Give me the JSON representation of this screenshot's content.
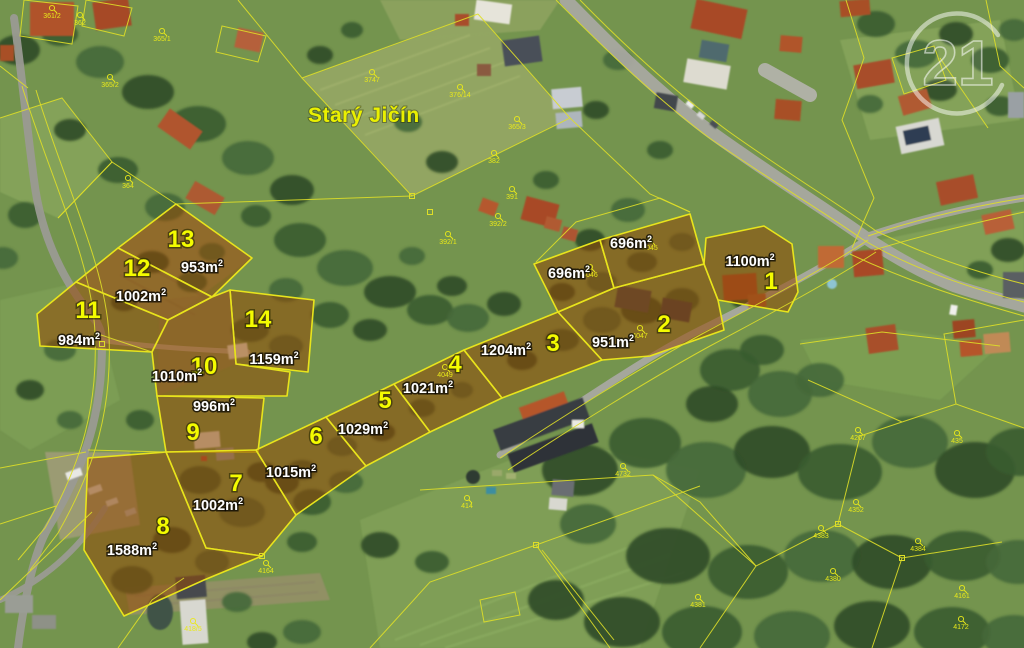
{
  "map": {
    "place_label": "Starý Jičín",
    "watermark_number": "21",
    "accent_colors": {
      "cadastral_line": "#dede28",
      "parcel_highlight": "rgba(148,72,6,0.55)",
      "parcel_number": "#f4fc00",
      "area_label": "#ffffff"
    },
    "area_unit": "m²",
    "parcels": [
      {
        "id": "13",
        "area": "953",
        "num": [
          181,
          247
        ],
        "area_pos": [
          202,
          272
        ],
        "poly": "176,204 252,258 212,297 118,248"
      },
      {
        "id": "12",
        "area": "1002",
        "num": [
          137,
          276
        ],
        "area_pos": [
          141,
          301
        ],
        "poly": "118,248 212,297 168,320 76,282"
      },
      {
        "id": "11",
        "area": "984",
        "num": [
          88,
          318
        ],
        "area_pos": [
          79,
          345
        ],
        "poly": "76,282 168,320 152,352 40,346 37,314"
      },
      {
        "id": "14",
        "area": "1159",
        "num": [
          258,
          327
        ],
        "area_pos": [
          274,
          364
        ],
        "poly": "230,290 314,300 308,372 236,364"
      },
      {
        "id": "10",
        "area": "1010",
        "num": [
          204,
          374
        ],
        "area_pos": [
          177,
          381
        ],
        "poly": "152,352 168,320 212,297 230,290 236,364 290,372 287,396 157,396"
      },
      {
        "id": "9",
        "area": "996",
        "num": [
          193,
          440
        ],
        "area_pos": [
          214,
          411
        ],
        "poly": "157,396 264,398 258,452 166,452"
      },
      {
        "id": "7",
        "area": "1002",
        "num": [
          236,
          491
        ],
        "area_pos": [
          218,
          510
        ],
        "poly": "166,452 256,450 296,515 262,556 206,548"
      },
      {
        "id": "8",
        "area": "1588",
        "num": [
          163,
          534
        ],
        "area_pos": [
          132,
          555
        ],
        "poly": "88,458 166,452 206,548 262,556 204,580 124,616 84,550"
      },
      {
        "id": "6",
        "area": "1015",
        "num": [
          316,
          444
        ],
        "area_pos": [
          291,
          477
        ],
        "poly": "256,450 326,417 366,466 296,515"
      },
      {
        "id": "5",
        "area": "1029",
        "num": [
          385,
          408
        ],
        "area_pos": [
          363,
          434
        ],
        "poly": "326,417 394,384 430,432 366,466"
      },
      {
        "id": "4",
        "area": "1021",
        "num": [
          455,
          372
        ],
        "area_pos": [
          428,
          393
        ],
        "poly": "394,384 464,350 502,398 430,432"
      },
      {
        "id": "3",
        "area": "1204",
        "num": [
          553,
          351
        ],
        "area_pos": [
          506,
          355
        ],
        "poly": "464,350 558,312 602,360 502,398"
      },
      {
        "id": "2",
        "area": "951",
        "num": [
          664,
          332
        ],
        "area_pos": [
          613,
          347
        ],
        "poly": "558,312 614,288 704,264 718,300 724,330 650,356 602,360"
      },
      {
        "id": "1",
        "area": "1100",
        "num": [
          771,
          289
        ],
        "area_pos": [
          750,
          266
        ],
        "poly": "706,238 764,226 792,244 798,292 788,312 718,300 704,264"
      },
      {
        "id": "",
        "area": "696",
        "num": null,
        "area_pos": [
          569,
          278
        ],
        "poly": "534,264 600,240 614,288 558,312"
      },
      {
        "id": "",
        "area": "696",
        "num": null,
        "area_pos": [
          631,
          248
        ],
        "poly": "600,240 690,214 704,264 614,288"
      }
    ],
    "refs": [
      {
        "t": "361/2",
        "x": 52,
        "y": 18
      },
      {
        "t": "362",
        "x": 80,
        "y": 25
      },
      {
        "t": "365/1",
        "x": 162,
        "y": 41
      },
      {
        "t": "365/2",
        "x": 110,
        "y": 87
      },
      {
        "t": "364",
        "x": 128,
        "y": 188
      },
      {
        "t": "3747",
        "x": 372,
        "y": 82
      },
      {
        "t": "376/14",
        "x": 460,
        "y": 97
      },
      {
        "t": "365/3",
        "x": 517,
        "y": 129
      },
      {
        "t": "382",
        "x": 494,
        "y": 163
      },
      {
        "t": "391",
        "x": 512,
        "y": 199
      },
      {
        "t": "392/2",
        "x": 498,
        "y": 226
      },
      {
        "t": "392/1",
        "x": 448,
        "y": 244
      },
      {
        "t": "4045",
        "x": 650,
        "y": 250
      },
      {
        "t": "4046",
        "x": 590,
        "y": 277
      },
      {
        "t": "4047",
        "x": 640,
        "y": 338
      },
      {
        "t": "4049",
        "x": 445,
        "y": 377
      },
      {
        "t": "4207",
        "x": 858,
        "y": 440
      },
      {
        "t": "435",
        "x": 957,
        "y": 443
      },
      {
        "t": "4352",
        "x": 856,
        "y": 512
      },
      {
        "t": "4383",
        "x": 821,
        "y": 538
      },
      {
        "t": "4380",
        "x": 833,
        "y": 581
      },
      {
        "t": "4384",
        "x": 918,
        "y": 551
      },
      {
        "t": "4161",
        "x": 962,
        "y": 598
      },
      {
        "t": "4172",
        "x": 961,
        "y": 629
      },
      {
        "t": "4732",
        "x": 623,
        "y": 476
      },
      {
        "t": "4381",
        "x": 698,
        "y": 607
      },
      {
        "t": "414",
        "x": 467,
        "y": 508
      },
      {
        "t": "4164",
        "x": 266,
        "y": 573
      },
      {
        "t": "418/5",
        "x": 193,
        "y": 631
      }
    ]
  }
}
